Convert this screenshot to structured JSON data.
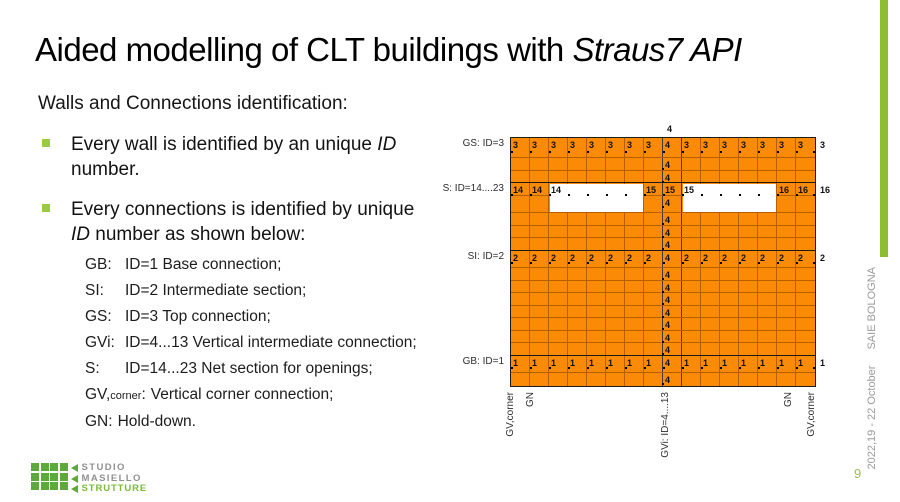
{
  "title": {
    "normal": "Aided modelling of CLT buildings with ",
    "italic": "Straus7 API"
  },
  "subtitle": "Walls and Connections identification:",
  "bullets": [
    {
      "pre": "Every wall is identified by an unique ",
      "em": "ID",
      "post": " number."
    },
    {
      "pre": "Every connections is identified by unique ",
      "em": "ID",
      "post": " number as shown below:"
    }
  ],
  "id_list": [
    {
      "prefix": "GB:",
      "sub": "",
      "suffix": "",
      "text": "ID=1 Base connection;",
      "aligned": true
    },
    {
      "prefix": "SI:",
      "sub": "",
      "suffix": "",
      "text": "ID=2 Intermediate section;",
      "aligned": true
    },
    {
      "prefix": "GS:",
      "sub": "",
      "suffix": "",
      "text": "ID=3 Top connection;",
      "aligned": true
    },
    {
      "prefix": "GVi:",
      "sub": "",
      "suffix": "",
      "text": "ID=4...13 Vertical intermediate connection;",
      "aligned": true
    },
    {
      "prefix": "S:",
      "sub": "",
      "suffix": "",
      "text": "ID=14...23 Net section for openings;",
      "aligned": true
    },
    {
      "prefix": "GV,",
      "sub": "corner",
      "suffix": ":",
      "text": "Vertical corner connection;",
      "aligned": false
    },
    {
      "prefix": "GN:",
      "sub": "",
      "suffix": "",
      "text": "Hold-down.",
      "aligned": false
    }
  ],
  "diagram": {
    "top_label": "4",
    "left_labels": [
      {
        "row": 0,
        "text": "GS: ID=3"
      },
      {
        "row": 3,
        "text": "S: ID=14....23"
      },
      {
        "row": 8,
        "text": "SI: ID=2"
      },
      {
        "row": 16,
        "text": "GB: ID=1"
      }
    ],
    "right_labels": [
      {
        "row": 0,
        "text": "3"
      },
      {
        "row": 3,
        "text": "16"
      },
      {
        "row": 8,
        "text": "2"
      },
      {
        "row": 16,
        "text": "1"
      }
    ],
    "bottom_labels": [
      {
        "x": -6,
        "text": "GV,corner"
      },
      {
        "x": 14,
        "text": "GN"
      },
      {
        "x": 149,
        "text": "GVi: ID=4....13"
      },
      {
        "x": 272,
        "text": "GN"
      },
      {
        "x": 295,
        "text": "GV,corner"
      }
    ],
    "grid": {
      "cols": 16,
      "col_width": 19,
      "row_heights": [
        20,
        13,
        12,
        13,
        17,
        13,
        12,
        13,
        17,
        13,
        12,
        13,
        12,
        13,
        12,
        13,
        17,
        13
      ],
      "center_col": 8,
      "center_value": "4",
      "label_rows": [
        {
          "row": 0,
          "value": "3",
          "center": "4"
        },
        {
          "row": 8,
          "value": "2",
          "center": "4"
        },
        {
          "row": 16,
          "value": "1",
          "center": "4"
        }
      ],
      "s_row": {
        "row": 3,
        "cells": {
          "0": "14",
          "1": "14",
          "2": "14",
          "7": "15",
          "8": "15",
          "9": "15",
          "14": "16",
          "15": "16"
        }
      },
      "openings": [
        {
          "row_start": 3,
          "row_end": 4,
          "col_start": 2,
          "col_end": 6
        },
        {
          "row_start": 3,
          "row_end": 4,
          "col_start": 9,
          "col_end": 13
        }
      ],
      "heavy_rows": [
        3,
        8,
        16
      ],
      "colors": {
        "cell": "#FB8B07",
        "line": "#B55F00",
        "heavy": "#1a1a1a",
        "center_line": "#3c3c3c"
      }
    }
  },
  "footer": {
    "date": "2022,19 - 22 October",
    "event": "SAIE BOLOGNA",
    "page": "9",
    "logo": {
      "line1": "STUDIO",
      "line2": "MASIELLO",
      "line3": "STRUTTURE"
    }
  },
  "accent": {
    "green_bar": "#8CBE2F",
    "bullet": "#9BCB3B",
    "page_num": "#9BBB59"
  }
}
